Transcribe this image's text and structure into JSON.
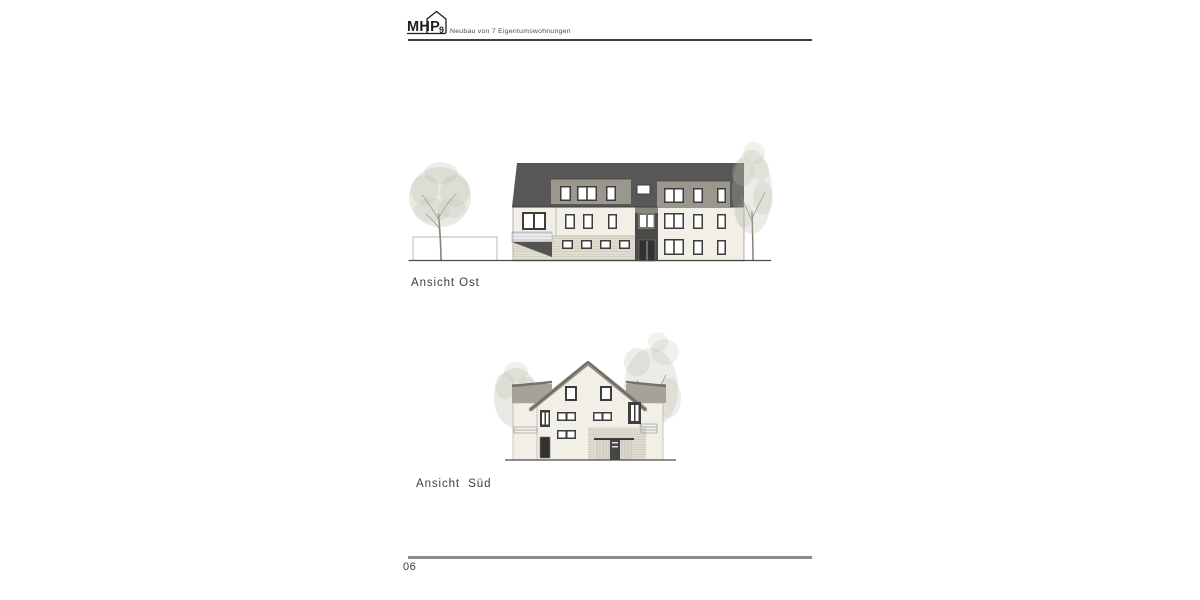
{
  "page": {
    "number": "06"
  },
  "header": {
    "logo_text": "MHP",
    "logo_number": "9",
    "subtitle": "Neubau von 7 Eigentumswohnungen"
  },
  "drawings": {
    "east": {
      "label": "Ansicht Ost"
    },
    "south": {
      "label": "Ansicht  Süd"
    }
  },
  "colors": {
    "paper": "#ffffff",
    "rule_dark": "#3f3f3e",
    "rule_gray": "#8c8c8c",
    "text": "#3c3c3b",
    "subtitle": "#4a4a49",
    "logo": "#1d1d1b",
    "roof": "#575756",
    "roof_band": "#8f8a7e",
    "dormer": "#9c978c",
    "dormer_side": "#a7a298",
    "dormer_cap": "#76716a",
    "facade": "#f2efe7",
    "edge": "#a9a69c",
    "entrance": "#4b4b4a",
    "entrance_panel": "#8a8680",
    "entrance_frame": "#77766f",
    "siding": "#e3dfd4",
    "siding_line": "#c9c5b8",
    "window_frame": "#3d3d3c",
    "window_pane": "#ffffff",
    "railing": "#d3d7da",
    "railing_line": "#9aa0a5",
    "shadow": "#54534e",
    "garage_door": "#dcd9d0",
    "garage_line": "#b9b5aa",
    "garage_dark": "#454543",
    "door_dark": "#313130",
    "foliage": "#b9b9a9",
    "trunk": "#8a8174",
    "ground": "#4a4a49",
    "fence": "#b3b1a8"
  }
}
